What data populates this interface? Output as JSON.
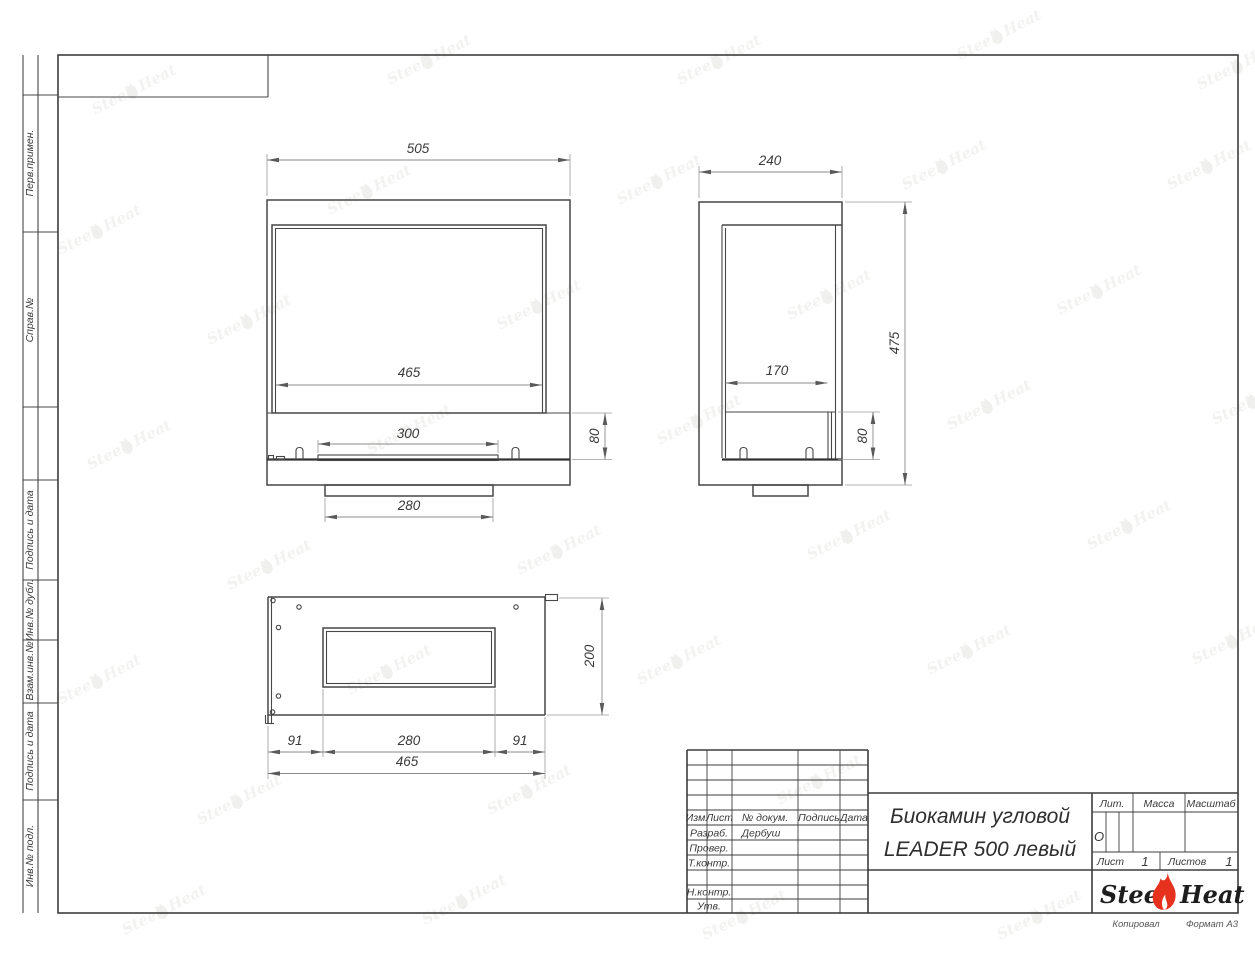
{
  "watermark": {
    "steel": "Steel",
    "heat": "Heat"
  },
  "margin_labels": {
    "perv": "Перв.примен.",
    "sprav": "Справ.№",
    "podpis1": "Подпись и дата",
    "inv_dubl": "Инв.№ дубл.",
    "vzam": "Взам.инв.№",
    "podpis2": "Подпись и дата",
    "inv_podl": "Инв.№ подл."
  },
  "dims": {
    "front_width": "505",
    "front_glass_width": "465",
    "front_burner_width": "300",
    "front_base_height": "80",
    "front_pedestal_width": "280",
    "side_depth": "240",
    "side_glass_depth": "170",
    "side_base_height": "80",
    "side_height": "475",
    "plan_depth": "200",
    "plan_margin_left": "91",
    "plan_opening_width": "280",
    "plan_margin_right": "91",
    "plan_width": "465"
  },
  "title_block": {
    "title_line1": "Биокамин угловой",
    "title_line2": "LEADER 500 левый",
    "col_izm": "Изм.",
    "col_list": "Лист",
    "col_doc": "№ докум.",
    "col_sign": "Подпись",
    "col_date": "Дата",
    "row_razrab": "Разраб.",
    "row_razrab_value": "Дербуш",
    "row_prover": "Провер.",
    "row_tkontr": "Т.контр.",
    "row_nkontr": "Н.контр.",
    "row_utv": "Утв.",
    "lit_label": "Лит.",
    "lit_value": "О",
    "mass_label": "Масса",
    "scale_label": "Масштаб",
    "sheet_label": "Лист",
    "sheet_value": "1",
    "sheets_label": "Листов",
    "sheets_value": "1",
    "brand_steel": "Steel",
    "brand_heat": "Heat",
    "footer_copy": "Копировал",
    "footer_format": "Формат А3"
  }
}
